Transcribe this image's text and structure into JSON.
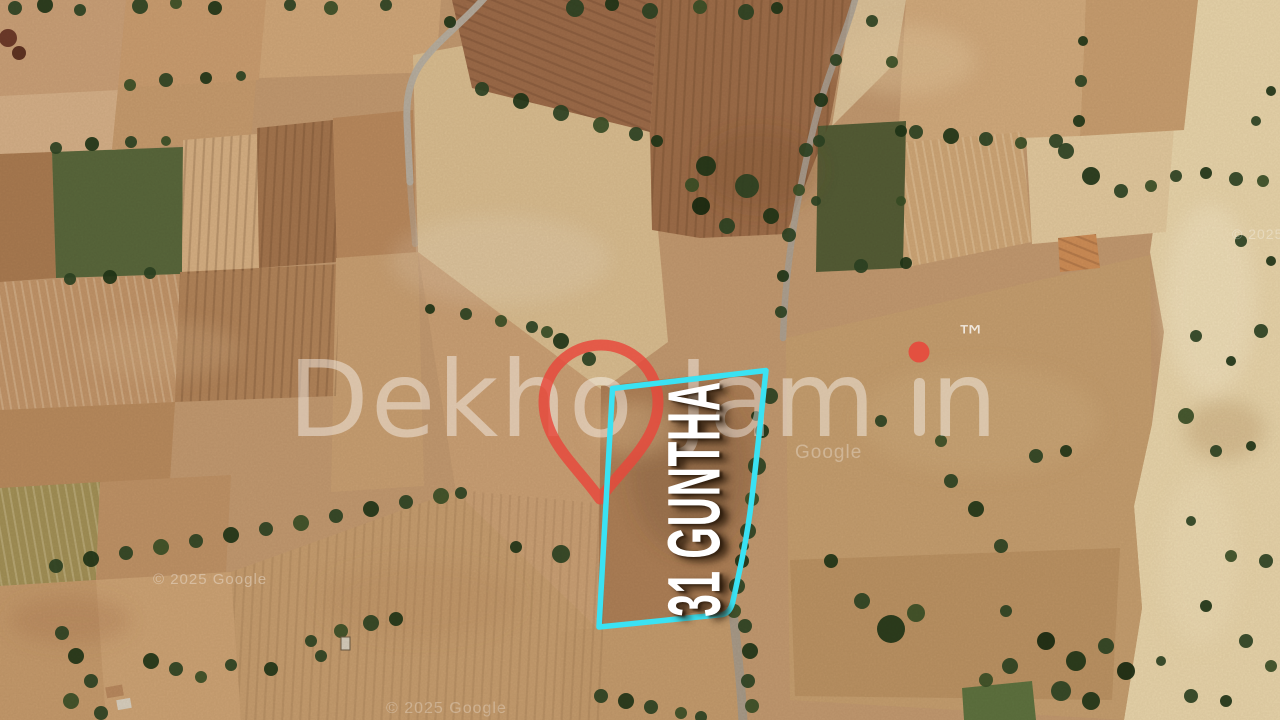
{
  "watermark": {
    "brand_left": "Dekho",
    "brand_right_pre": "Jam",
    "brand_right_post": "n",
    "brand_full": "DekhoJamin",
    "trademark": "™",
    "accent_red": "#e8473a"
  },
  "plot": {
    "label": "31 GUNTHA",
    "outline_color": "#3ae2f3"
  },
  "imagery_credits": [
    {
      "text": "© 2025 Google"
    },
    {
      "text": "© 2025 Google"
    },
    {
      "text": "Google"
    },
    {
      "text": "© 2025 Google"
    }
  ]
}
